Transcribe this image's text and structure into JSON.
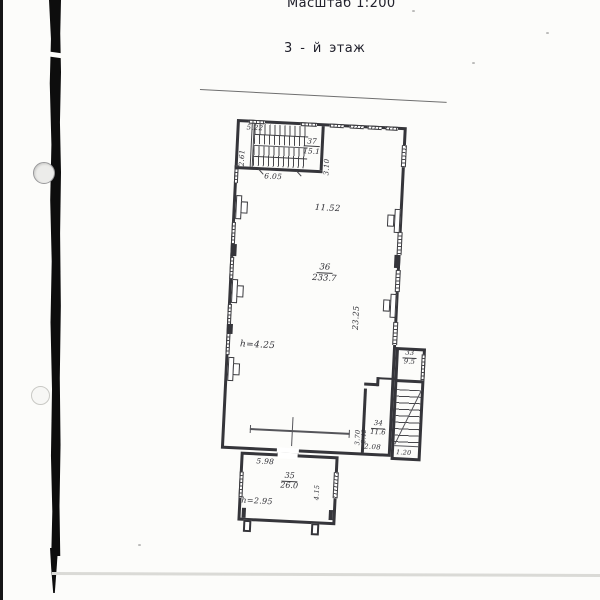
{
  "header": {
    "scale_label": "Масштаб 1:200",
    "floor_label": "3 - й  этаж"
  },
  "rooms": {
    "r37": {
      "number": "37",
      "area": "15.1"
    },
    "r36": {
      "number": "36",
      "area": "233.7"
    },
    "r34": {
      "number": "34",
      "area": "11.6"
    },
    "r33": {
      "number": "33",
      "area": "9.5"
    },
    "r35": {
      "number": "35",
      "area": "26.0"
    }
  },
  "dimensions": {
    "stair_top_width": "5.22",
    "stair_left_depth": "2.61",
    "stair_bottom_width": "6.05",
    "stair_hall_depth": "3.10",
    "main_top_width": "11.52",
    "main_right_height": "23.25",
    "main_ceiling_height": "h=4.25",
    "room34_left_height": "3.70",
    "room34_inner": "2.42",
    "room34_bottom_width": "2.08",
    "stairwell_bottom_width": "1.20",
    "annex_top_width": "5.98",
    "annex_right_depth": "4.15",
    "annex_ceiling_height": "h=2.95"
  }
}
